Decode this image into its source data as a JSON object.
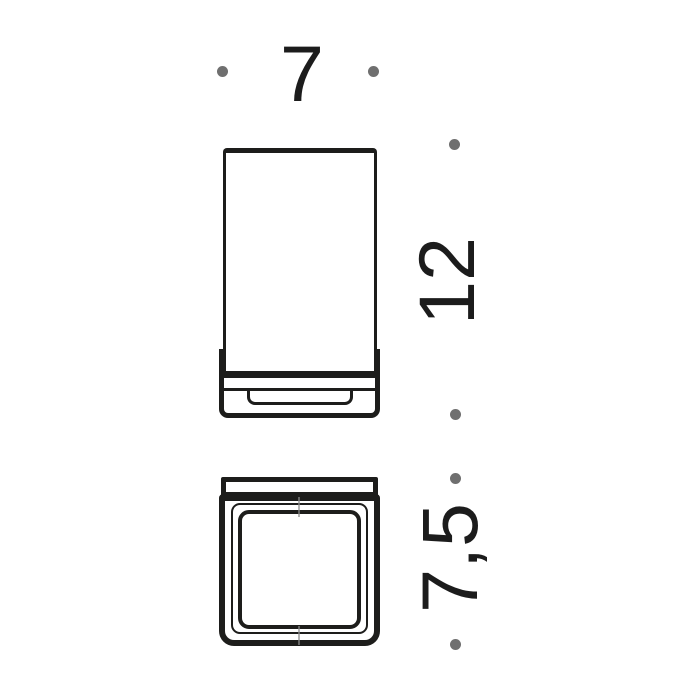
{
  "drawing": {
    "dimensions": {
      "width": "7",
      "height": "12",
      "depth": "7,5"
    },
    "colors": {
      "line": "#1d1d1b",
      "dot": "#6f6f6f",
      "text": "#1c1c1c",
      "background": "#ffffff"
    }
  }
}
